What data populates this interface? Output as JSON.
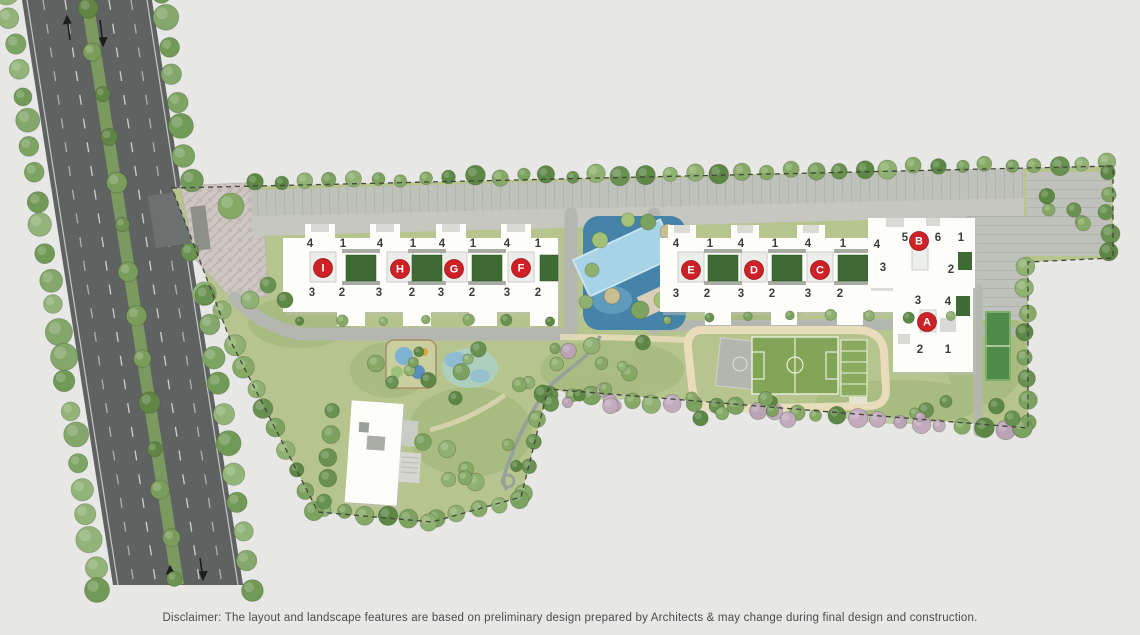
{
  "disclaimer": "Disclaimer: The layout and landscape features are based on preliminary design prepared by Architects & may change during final design and construction.",
  "colors": {
    "marker_red": "#ce2127",
    "marker_text": "#ffffff",
    "number_text": "#3a3e3c",
    "site_green": "#b5c58d",
    "pool_deck": "#4584a8",
    "pool_water": "#a6d4e6",
    "field_green": "#82a557",
    "asphalt": "#5e6361"
  },
  "towers": [
    {
      "id": "I",
      "x": 323,
      "y": 268
    },
    {
      "id": "H",
      "x": 400,
      "y": 269
    },
    {
      "id": "G",
      "x": 454,
      "y": 269
    },
    {
      "id": "F",
      "x": 521,
      "y": 268
    },
    {
      "id": "E",
      "x": 691,
      "y": 270
    },
    {
      "id": "D",
      "x": 754,
      "y": 270
    },
    {
      "id": "C",
      "x": 820,
      "y": 270
    },
    {
      "id": "B",
      "x": 919,
      "y": 241
    },
    {
      "id": "A",
      "x": 927,
      "y": 322
    }
  ],
  "unit_numbers": [
    {
      "t": "4",
      "x": 310,
      "y": 244
    },
    {
      "t": "1",
      "x": 343,
      "y": 244
    },
    {
      "t": "4",
      "x": 380,
      "y": 244
    },
    {
      "t": "1",
      "x": 413,
      "y": 244
    },
    {
      "t": "4",
      "x": 442,
      "y": 244
    },
    {
      "t": "1",
      "x": 473,
      "y": 244
    },
    {
      "t": "4",
      "x": 507,
      "y": 244
    },
    {
      "t": "1",
      "x": 538,
      "y": 244
    },
    {
      "t": "3",
      "x": 312,
      "y": 293
    },
    {
      "t": "2",
      "x": 342,
      "y": 293
    },
    {
      "t": "3",
      "x": 379,
      "y": 293
    },
    {
      "t": "2",
      "x": 412,
      "y": 293
    },
    {
      "t": "3",
      "x": 441,
      "y": 293
    },
    {
      "t": "2",
      "x": 472,
      "y": 293
    },
    {
      "t": "3",
      "x": 507,
      "y": 293
    },
    {
      "t": "2",
      "x": 538,
      "y": 293
    },
    {
      "t": "4",
      "x": 676,
      "y": 244
    },
    {
      "t": "1",
      "x": 710,
      "y": 244
    },
    {
      "t": "4",
      "x": 741,
      "y": 244
    },
    {
      "t": "1",
      "x": 775,
      "y": 244
    },
    {
      "t": "4",
      "x": 808,
      "y": 244
    },
    {
      "t": "1",
      "x": 843,
      "y": 244
    },
    {
      "t": "4",
      "x": 877,
      "y": 245
    },
    {
      "t": "3",
      "x": 676,
      "y": 294
    },
    {
      "t": "2",
      "x": 707,
      "y": 294
    },
    {
      "t": "3",
      "x": 741,
      "y": 294
    },
    {
      "t": "2",
      "x": 772,
      "y": 294
    },
    {
      "t": "3",
      "x": 808,
      "y": 294
    },
    {
      "t": "2",
      "x": 840,
      "y": 294
    },
    {
      "t": "5",
      "x": 905,
      "y": 238
    },
    {
      "t": "6",
      "x": 938,
      "y": 238
    },
    {
      "t": "1",
      "x": 961,
      "y": 238
    },
    {
      "t": "3",
      "x": 883,
      "y": 268
    },
    {
      "t": "2",
      "x": 951,
      "y": 270
    },
    {
      "t": "3",
      "x": 918,
      "y": 301
    },
    {
      "t": "4",
      "x": 948,
      "y": 302
    },
    {
      "t": "2",
      "x": 920,
      "y": 350
    },
    {
      "t": "1",
      "x": 948,
      "y": 350
    }
  ]
}
